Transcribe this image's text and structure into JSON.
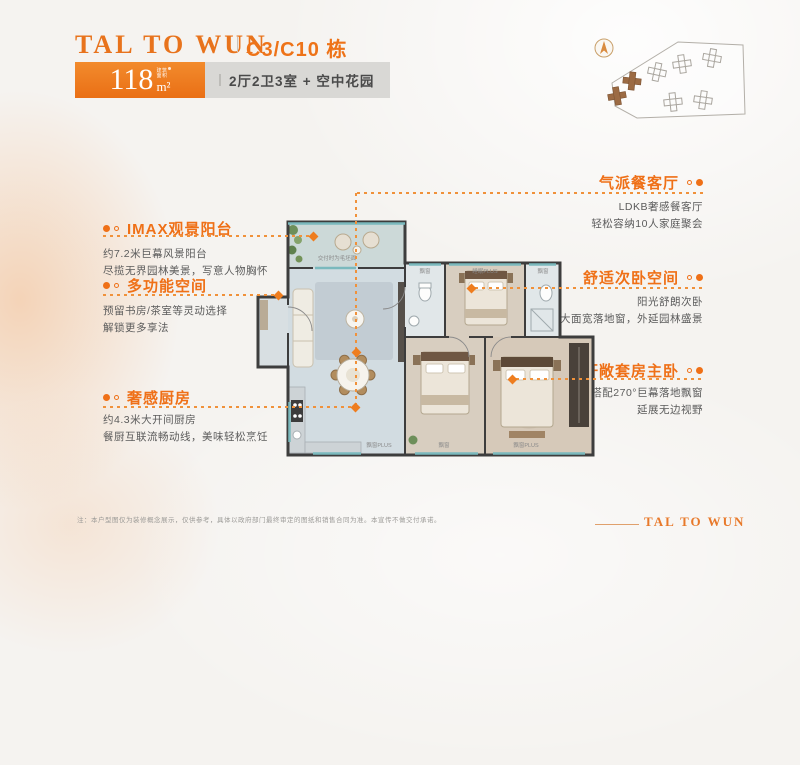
{
  "header": {
    "logo": "TAL TO WUN",
    "building": "C3/C10 栋",
    "area_value": "118",
    "area_note_top": "建筑",
    "area_note_bottom": "面积",
    "area_unit": "m²",
    "spec": "2厅2卫3室 + 空中花园"
  },
  "left_features": [
    {
      "title": "IMAX观景阳台",
      "lines": [
        "约7.2米巨幕风景阳台",
        "尽揽无界园林美景，写意人物胸怀"
      ]
    },
    {
      "title": "多功能空间",
      "lines": [
        "预留书房/茶室等灵动选择",
        "解锁更多享法"
      ]
    },
    {
      "title": "奢感厨房",
      "lines": [
        "约4.3米大开间厨房",
        "餐厨互联流畅动线，美味轻松烹饪"
      ]
    }
  ],
  "right_features": [
    {
      "title": "气派餐客厅",
      "lines": [
        "LDKB奢感餐客厅",
        "轻松容纳10人家庭聚会"
      ]
    },
    {
      "title": "舒适次卧空间",
      "lines": [
        "阳光舒朗次卧",
        "大面宽落地窗，外延园林盛景"
      ]
    },
    {
      "title": "轩敞套房主卧",
      "lines": [
        "搭配270°巨幕落地飘窗",
        "延展无边视野"
      ]
    }
  ],
  "floorplan": {
    "balcony_note": "交付时为毛坯面",
    "room_labels": {
      "bay_top_left": "飘窗",
      "bedroom2": "睡眠PLUS",
      "bay_top_right": "飘窗",
      "bay_bottom_left": "飘窗PLUS",
      "bay_bottom_mid": "飘窗",
      "bay_bottom_master": "飘窗PLUS"
    }
  },
  "footer": {
    "disclaimer": "注：本户型图仅为装修概念展示，仅供参考，具体以政府部门最终审定的图纸和销售合同为准。本宣传不做交付承诺。",
    "logo": "TAL TO WUN"
  },
  "colors": {
    "accent": "#ee7318",
    "wall": "#3d3d3d",
    "window": "#7ab9bd"
  }
}
